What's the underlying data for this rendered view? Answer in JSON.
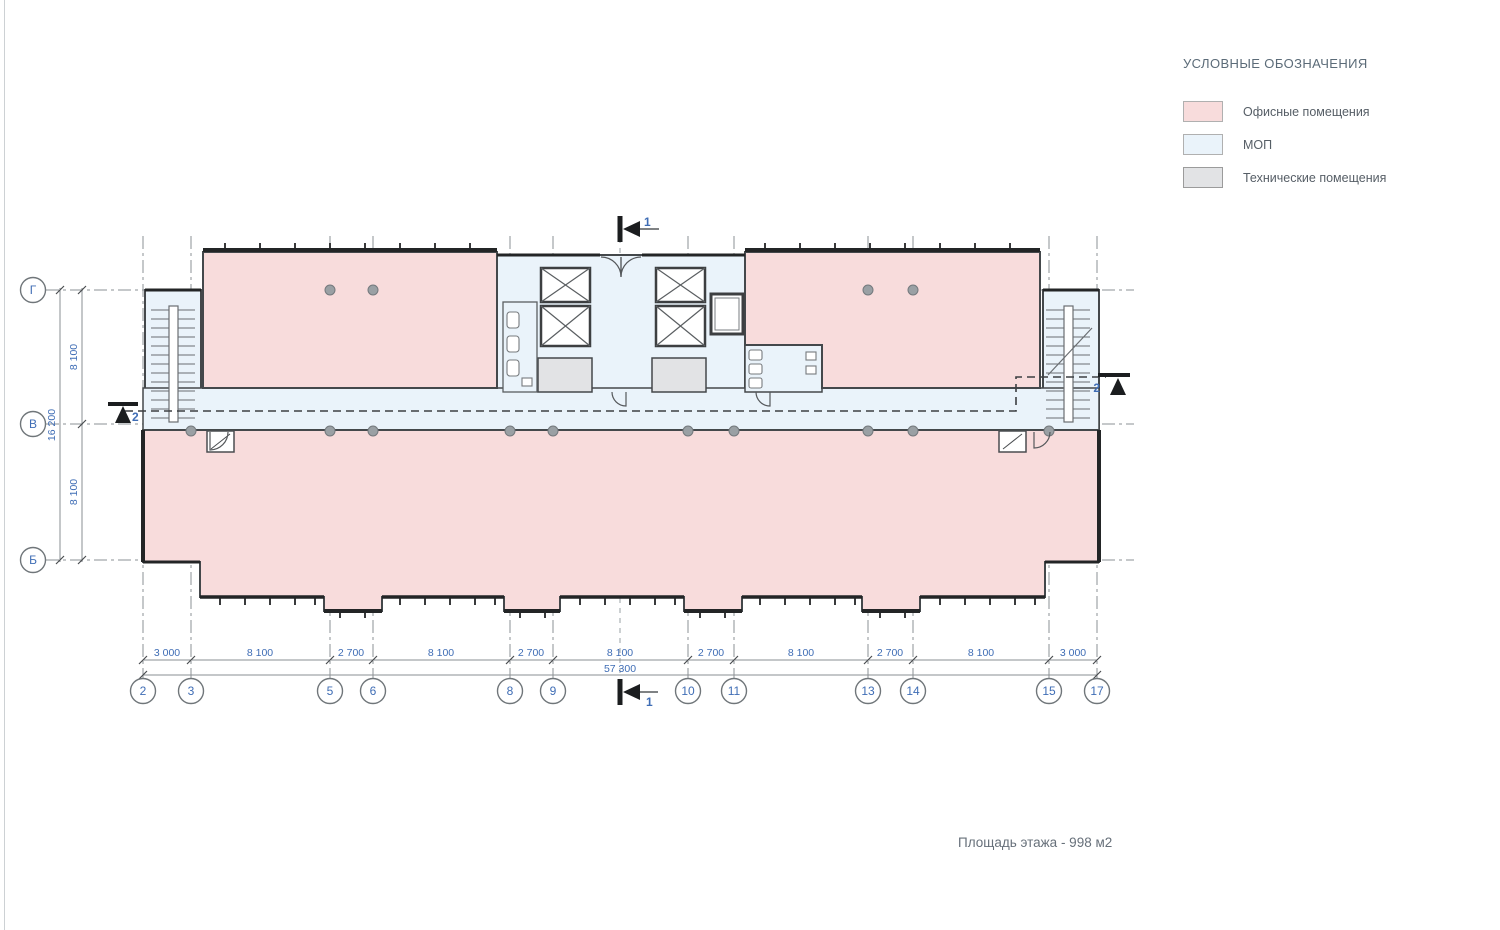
{
  "legend": {
    "title": "УСЛОВНЫЕ ОБОЗНАЧЕНИЯ",
    "items": [
      {
        "id": "offices",
        "label": "Офисные помещения",
        "color": "#f8dcdc",
        "border": "#b9b9b9"
      },
      {
        "id": "mop",
        "label": "МОП",
        "color": "#eaf3fa",
        "border": "#b9b9b9"
      },
      {
        "id": "technical",
        "label": "Технические помещения",
        "color": "#e2e3e5",
        "border": "#9b9b9b"
      }
    ]
  },
  "plan": {
    "grid_columns": [
      "2",
      "3",
      "5",
      "6",
      "8",
      "9",
      "10",
      "11",
      "13",
      "14",
      "15",
      "17"
    ],
    "grid_rows": [
      "Г",
      "В",
      "Б"
    ],
    "dimensions": {
      "bottom_segments": [
        "3 000",
        "8 100",
        "2 700",
        "8 100",
        "2 700",
        "8 100",
        "2 700",
        "8 100",
        "2 700",
        "8 100",
        "3 000"
      ],
      "bottom_total": "57 300",
      "left_segments": [
        "8 100",
        "8 100"
      ],
      "left_total": "16 200"
    },
    "section_markers": {
      "section1": "1",
      "section2": "2"
    },
    "colors": {
      "walls": "#44484b",
      "glazing": "#232526",
      "grid_line": "#8b9094",
      "dim_text": "#3f6db5",
      "column_fill": "#9aa0a4"
    }
  },
  "footer": {
    "area_text": "Площадь этажа - 998 м2"
  }
}
